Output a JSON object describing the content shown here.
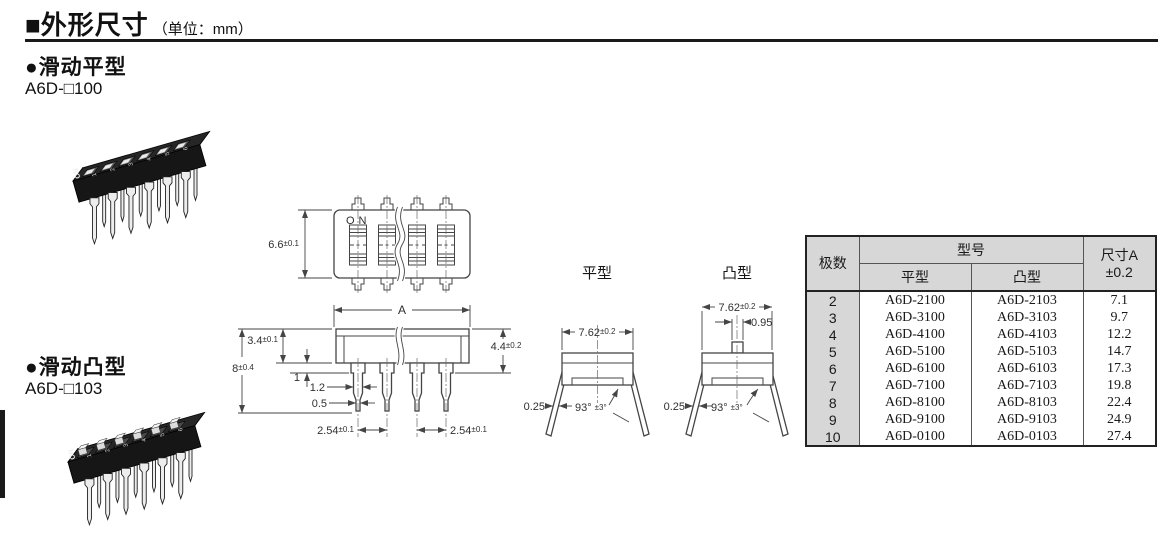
{
  "header": {
    "bullet": "■",
    "title": "外形尺寸",
    "unit": "（单位：mm）"
  },
  "sections": {
    "flat": {
      "label": "●滑动平型",
      "model": "A6D-□100"
    },
    "raised": {
      "label": "●滑动凸型",
      "model": "A6D-□103"
    }
  },
  "drawing": {
    "on_label": "ON",
    "top_height_main": "6.6",
    "top_height_tol": "±0.1",
    "width_label": "A",
    "body_height_main": "3.4",
    "body_height_tol": "±0.1",
    "overall_height_main": "8",
    "overall_height_tol": "±0.4",
    "side_height_main": "4.4",
    "side_height_tol": "±0.2",
    "stand_height": "1",
    "pin_width": "1.2",
    "pin_tip_width": "0.5",
    "pitch_left_main": "2.54",
    "pitch_left_tol": "±0.1",
    "pitch_right_main": "2.54",
    "pitch_right_tol": "±0.1"
  },
  "side_views": {
    "flat": {
      "label": "平型",
      "width_main": "7.62",
      "width_tol": "±0.2",
      "lead_thickness": "0.25",
      "angle_main": "93°",
      "angle_tol": "±3°"
    },
    "raised": {
      "label": "凸型",
      "width_main": "7.62",
      "width_tol": "±0.2",
      "actuator_width": "0.95",
      "lead_thickness": "0.25",
      "angle_main": "93°",
      "angle_tol": "±3°"
    }
  },
  "photos": {
    "on_label": "ON",
    "digits": [
      "1",
      "2",
      "3",
      "4",
      "5",
      "6"
    ]
  },
  "table": {
    "header": {
      "poles": "极数",
      "model": "型号",
      "flat": "平型",
      "raised": "凸型",
      "dim_line1": "尺寸A",
      "dim_line2": "±0.2"
    },
    "rows": [
      {
        "poles": "2",
        "flat": "A6D-2100",
        "raised": "A6D-2103",
        "dim": "7.1"
      },
      {
        "poles": "3",
        "flat": "A6D-3100",
        "raised": "A6D-3103",
        "dim": "9.7"
      },
      {
        "poles": "4",
        "flat": "A6D-4100",
        "raised": "A6D-4103",
        "dim": "12.2"
      },
      {
        "poles": "5",
        "flat": "A6D-5100",
        "raised": "A6D-5103",
        "dim": "14.7"
      },
      {
        "poles": "6",
        "flat": "A6D-6100",
        "raised": "A6D-6103",
        "dim": "17.3"
      },
      {
        "poles": "7",
        "flat": "A6D-7100",
        "raised": "A6D-7103",
        "dim": "19.8"
      },
      {
        "poles": "8",
        "flat": "A6D-8100",
        "raised": "A6D-8103",
        "dim": "22.4"
      },
      {
        "poles": "9",
        "flat": "A6D-9100",
        "raised": "A6D-9103",
        "dim": "24.9"
      },
      {
        "poles": "10",
        "flat": "A6D-0100",
        "raised": "A6D-0103",
        "dim": "27.4"
      }
    ]
  }
}
